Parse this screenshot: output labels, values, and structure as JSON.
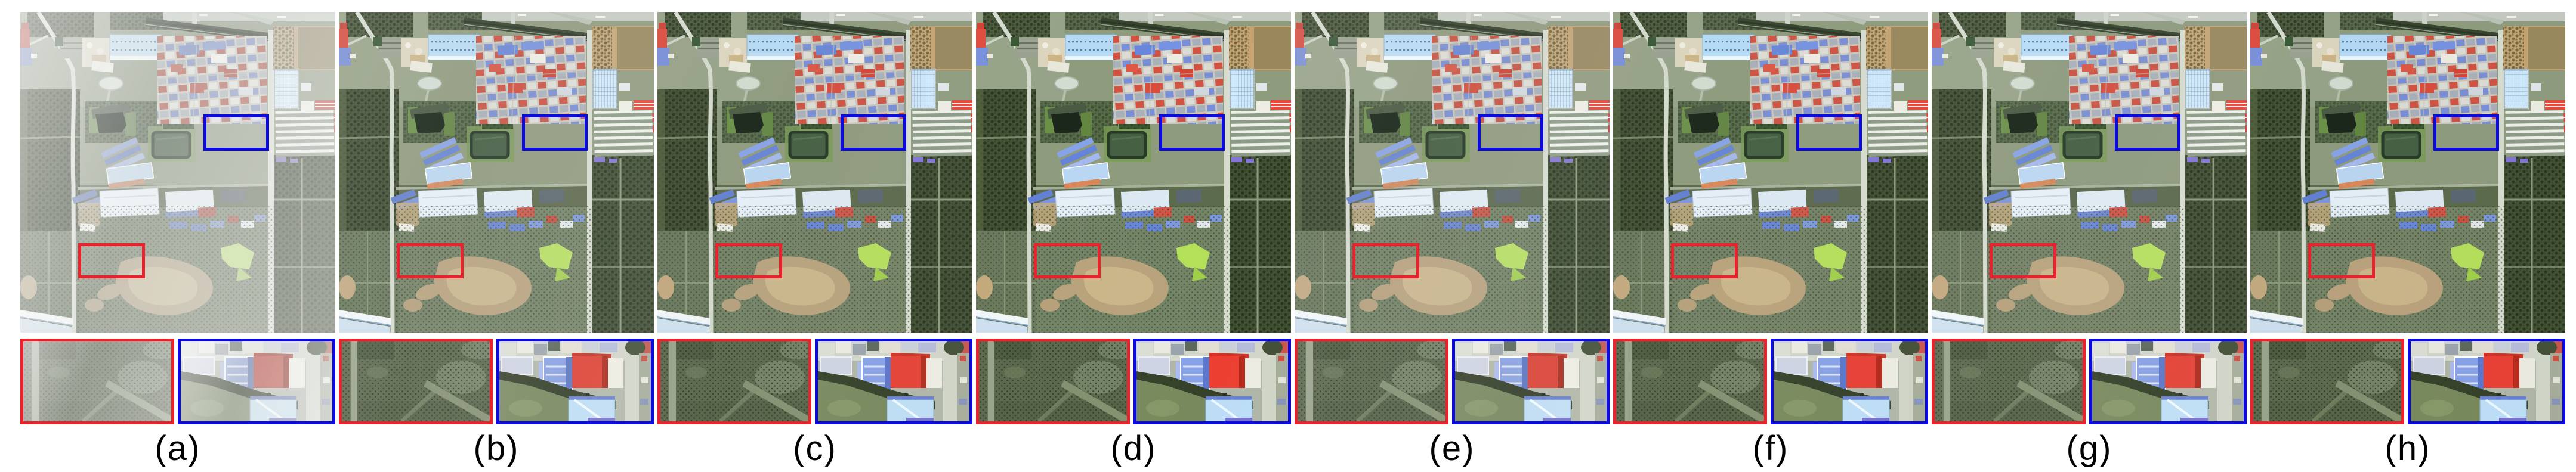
{
  "figure": {
    "description": "Eight-panel qualitative comparison of one hazy remote-sensing scene; each panel shows the full satellite image with a red and a blue highlight box plus two zoomed crops below",
    "colors": {
      "red_annotation": "#e8232e",
      "blue_annotation": "#0b0be0",
      "page_background": "#ffffff"
    },
    "zoom_regions": [
      {
        "color": "red",
        "location": "orchard / farmland area, lower left of scene"
      },
      {
        "color": "blue",
        "location": "buildings with red roof and blue roofs, center right of scene"
      }
    ],
    "panels": [
      {
        "label": "(a)",
        "appearance": "hazy input image",
        "haze_opacity": 0.6,
        "filter": "saturate(0.70) brightness(1.06) contrast(0.93)"
      },
      {
        "label": "(b)",
        "appearance": "dehazed result",
        "haze_opacity": 0.1,
        "filter": "saturate(1.02) brightness(1.02) contrast(1.00)"
      },
      {
        "label": "(c)",
        "appearance": "dehazed result",
        "haze_opacity": 0.04,
        "filter": "saturate(1.08) brightness(0.99) contrast(1.05)"
      },
      {
        "label": "(d)",
        "appearance": "dehazed result",
        "haze_opacity": 0.02,
        "filter": "saturate(1.14) brightness(0.985) contrast(1.07)"
      },
      {
        "label": "(e)",
        "appearance": "dehazed result",
        "haze_opacity": 0.07,
        "filter": "saturate(1.00) brightness(1.02) contrast(1.00)"
      },
      {
        "label": "(f)",
        "appearance": "dehazed result",
        "haze_opacity": 0.03,
        "filter": "saturate(1.10) brightness(0.99) contrast(1.05)"
      },
      {
        "label": "(g)",
        "appearance": "dehazed result",
        "haze_opacity": 0.05,
        "filter": "saturate(1.06) brightness(1.00) contrast(1.04)"
      },
      {
        "label": "(h)",
        "appearance": "dehazed result",
        "haze_opacity": 0.02,
        "filter": "saturate(1.12) brightness(0.98) contrast(1.06)"
      }
    ]
  }
}
